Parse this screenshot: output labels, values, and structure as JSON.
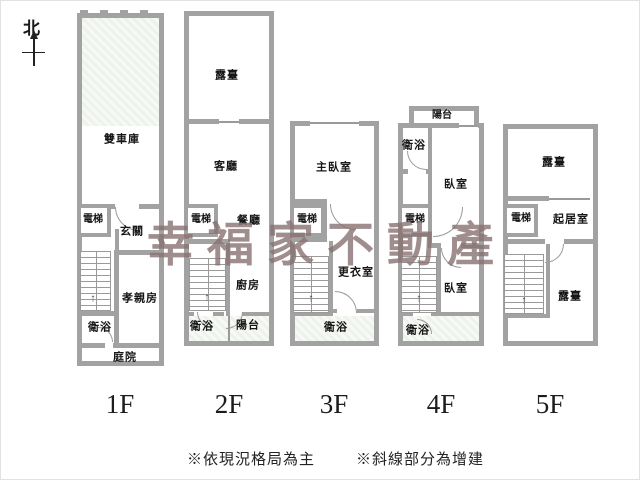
{
  "compass": {
    "north_label": "北"
  },
  "watermark": {
    "text": "幸福家不動產",
    "color": "#887070"
  },
  "symbols": {
    "stairs_up_arrow": "↑"
  },
  "floors": [
    {
      "label": "1F",
      "rooms": {
        "garage": "雙車庫",
        "elevator": "電梯",
        "foyer": "玄關",
        "parents_room": "孝親房",
        "bathroom": "衛浴",
        "courtyard": "庭院"
      }
    },
    {
      "label": "2F",
      "rooms": {
        "terrace": "露臺",
        "living_room": "客廳",
        "elevator": "電梯",
        "dining_room": "餐廳",
        "kitchen": "廚房",
        "bathroom": "衛浴",
        "balcony": "陽台"
      }
    },
    {
      "label": "3F",
      "rooms": {
        "master_bedroom": "主臥室",
        "elevator": "電梯",
        "walk_in_closet": "更衣室",
        "bathroom": "衛浴"
      }
    },
    {
      "label": "4F",
      "rooms": {
        "balcony": "陽台",
        "bathroom_upper": "衛浴",
        "bedroom_upper": "臥室",
        "elevator": "電梯",
        "bedroom_lower": "臥室",
        "bathroom_lower": "衛浴"
      }
    },
    {
      "label": "5F",
      "rooms": {
        "terrace_upper": "露臺",
        "elevator": "電梯",
        "sitting_room": "起居室",
        "terrace_lower": "露臺"
      }
    }
  ],
  "footnotes": [
    "※依現況格局為主",
    "※斜線部分為增建"
  ],
  "colors": {
    "wall": "#a2a2a2",
    "addition_fill": "#edf3eb",
    "watermark": "#887070"
  }
}
